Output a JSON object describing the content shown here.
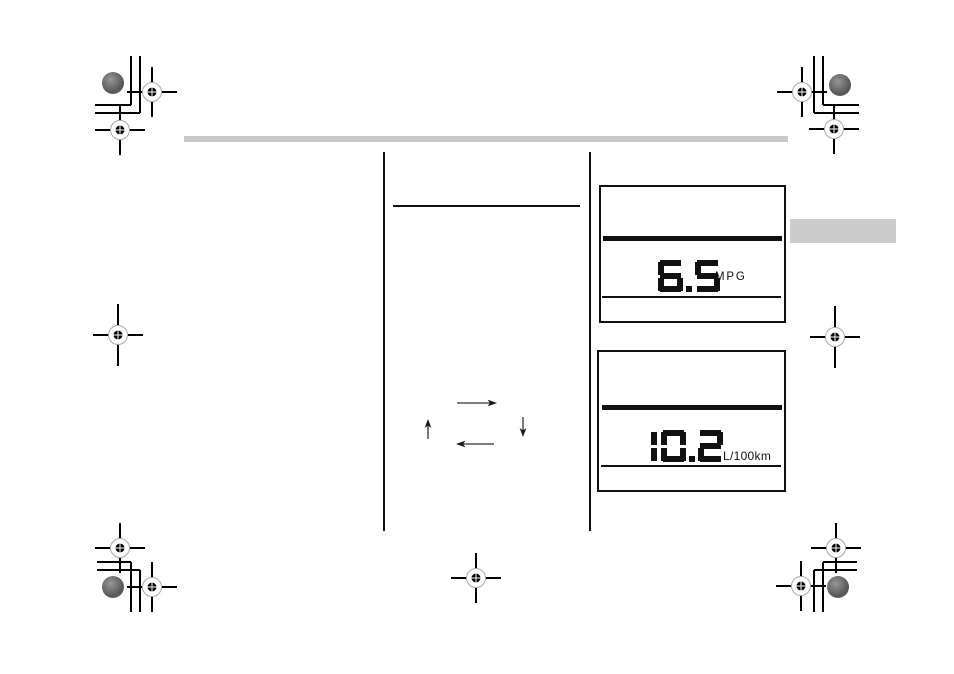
{
  "header": {
    "rule_color": "#c9c9c9"
  },
  "chapter_tab": {
    "color": "#cbcbcb"
  },
  "fuel_economy_displays": [
    {
      "value": "6.5",
      "unit": "MPG"
    },
    {
      "value": "10.2",
      "unit": "L/100km"
    }
  ],
  "colors": {
    "ink": "#111111",
    "registration_circle": "#a9a9a9",
    "ink_patch": "#5c5c5c"
  }
}
